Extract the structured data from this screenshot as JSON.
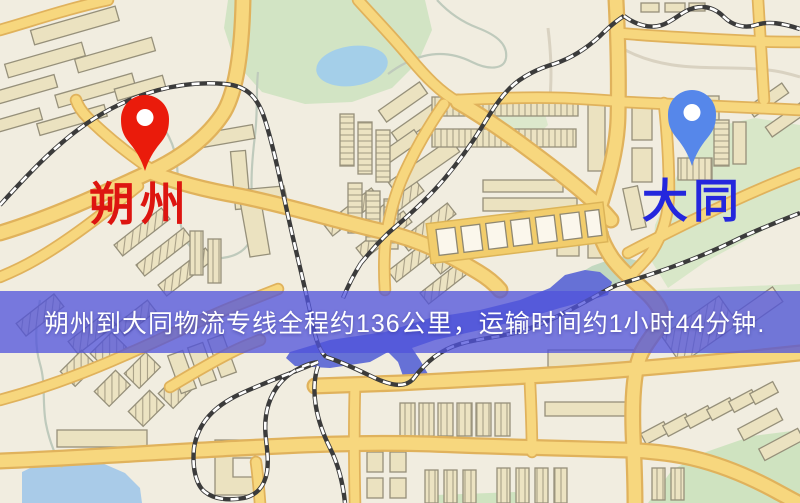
{
  "banner": {
    "text": "朔州到大同物流专线全程约136公里，运输时间约1小时44分钟.",
    "background": "#5053dc",
    "text_color": "#ffffff"
  },
  "route": {
    "origin": "朔州",
    "destination": "大同",
    "distance": "约136公里",
    "duration": "约1小时44分钟"
  },
  "markers": {
    "origin": {
      "label": "朔州",
      "pin_color": "#ea1b0b",
      "label_color": "#dd1510",
      "icon": "map-pin"
    },
    "destination": {
      "label": "大同",
      "pin_color": "#5687ea",
      "label_color": "#2427dd",
      "icon": "map-pin"
    }
  },
  "map_colors": {
    "background": "#f1ede0",
    "road_fill": "#f7d77e",
    "road_casing": "#e0b25c",
    "park": "#d2e4c4",
    "water_light": "#a9cbe8",
    "water_dark": "#6671d6",
    "railway": "#3b3b3b",
    "building": "#ebe2c0"
  }
}
